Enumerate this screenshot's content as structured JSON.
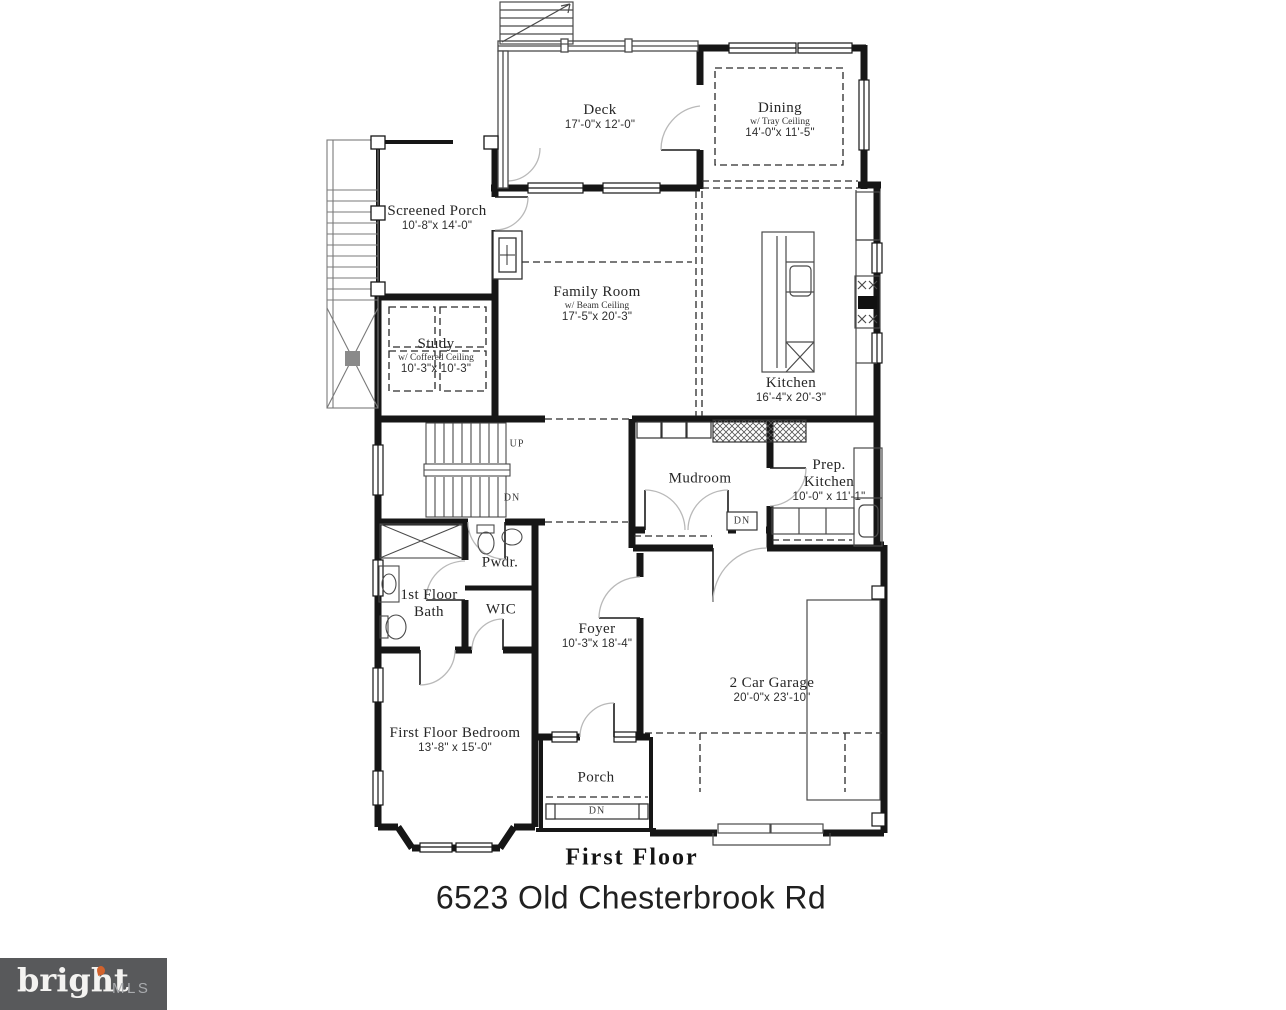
{
  "title": {
    "floor": "First Floor",
    "address": "6523 Old Chesterbrook Rd"
  },
  "logo": {
    "brand": "bright",
    "suffix": "MLS",
    "bg_color": "#58595b",
    "accent_color": "#d2622c"
  },
  "colors": {
    "wall": "#161616",
    "dashed": "#2a2a2a",
    "fixture": "#4a4a4a"
  },
  "rooms": [
    {
      "name": "Deck",
      "dims": "17'-0\"x 12'-0\""
    },
    {
      "name": "Dining",
      "sub": "w/ Tray Ceiling",
      "dims": "14'-0\"x 11'-5\""
    },
    {
      "name": "Screened Porch",
      "dims": "10'-8\"x 14'-0\""
    },
    {
      "name": "Family Room",
      "sub": "w/ Beam Ceiling",
      "dims": "17'-5\"x 20'-3\""
    },
    {
      "name": "Study",
      "sub": "w/ Coffered Ceiling",
      "dims": "10'-3\"x 10'-3\""
    },
    {
      "name": "Kitchen",
      "dims": "16'-4\"x 20'-3\""
    },
    {
      "name": "Mudroom"
    },
    {
      "name": "Prep. Kitchen",
      "dims": "10'-0\" x 11'-1\""
    },
    {
      "name": "Pwdr."
    },
    {
      "name": "1st Floor Bath"
    },
    {
      "name": "WIC"
    },
    {
      "name": "Foyer",
      "dims": "10'-3\"x 18'-4\""
    },
    {
      "name": "First Floor Bedroom",
      "dims": "13'-8\" x 15'-0\""
    },
    {
      "name": "2 Car Garage",
      "dims": "20'-0\"x 23'-10\""
    },
    {
      "name": "Porch"
    }
  ],
  "stairs": {
    "up": "UP",
    "down": "DN"
  }
}
